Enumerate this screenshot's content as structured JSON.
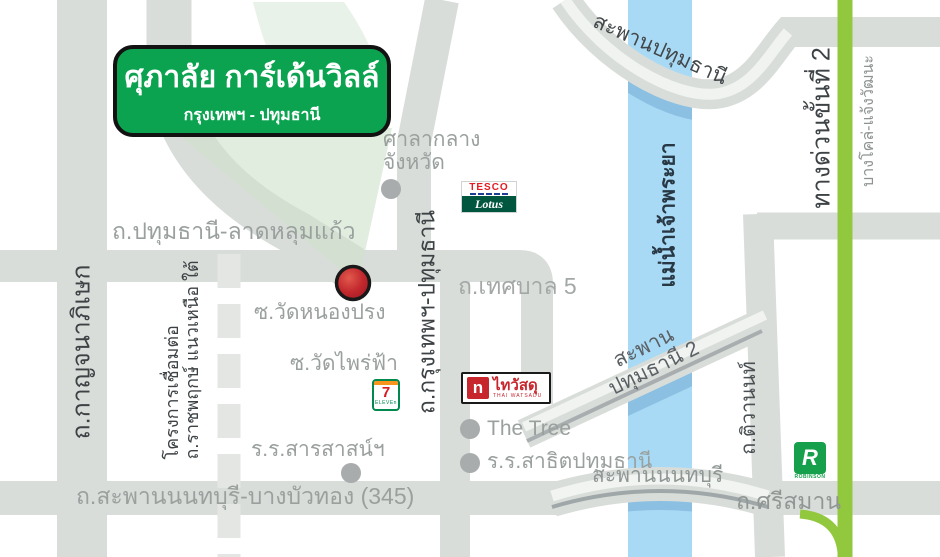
{
  "project_badge": {
    "title": "ศุภาลัย การ์เด้นวิลล์",
    "subtitle": "กรุงเทพฯ - ปทุมธานี"
  },
  "roads": {
    "kanchanaphisek": "ถ.กาญจนาภิเษก",
    "pathumthani_latlumkaeo": "ถ.ปทุมธานี-ลาดหลุมแก้ว",
    "krungthep_pathumthani": "ถ.กรุงเทพฯ-ปทุมธานี",
    "thetsaban5": "ถ.เทศบาล 5",
    "ratchaphruek_project_line1": "โครงการเชื่อมต่อ",
    "ratchaphruek_project_line2": "ถ.ราชพฤกษ์ แนวเหนือ ใต้",
    "soi_wat_nong_prong": "ซ.วัดหนองปรง",
    "soi_wat_phrai_fa": "ซ.วัดไพร่ฟ้า",
    "saphan_nonthaburi_bangbuathong": "ถ.สะพานนนทบุรี-บางบัวทอง (345)",
    "tiwanon": "ถ.ติวานนท์",
    "srisaman": "ถ.ศรีสมาน"
  },
  "expressway": {
    "name": "ทางด่วนขั้นที่ 2",
    "route": "บางโคล่-แจ้งวัฒนะ",
    "color": "#92c83e"
  },
  "river": {
    "name": "แม่น้ำเจ้าพระยา",
    "color": "#a9daf5"
  },
  "bridges": {
    "pathumthani": "สะพานปทุมธานี",
    "pathumthani2_line1": "สะพาน",
    "pathumthani2_line2": "ปทุมธานี 2",
    "nonthaburi": "สะพานนนทบุรี"
  },
  "landmarks": {
    "provincial_hall_line1": "ศาลากลาง",
    "provincial_hall_line2": "จังหวัด",
    "the_tree": "The Tree",
    "sarasas_school": "ร.ร.สารสาสน์ฯ",
    "satit_pathumthani_school": "ร.ร.สาธิตปทุมธานี"
  },
  "logos": {
    "tesco": "TESCO",
    "lotus": "Lotus",
    "seven": "7",
    "eleven": "ELEVEn",
    "thaiwatsadu_house": "n",
    "thaiwatsadu": "ไทวัสดุ",
    "thaiwatsadu_en": "THAI WATSADU",
    "robinson_r": "R",
    "robinson": "ROBINSON"
  },
  "colors": {
    "road_gray": "#d9ddd9",
    "badge_green": "#0ba350",
    "marker_red": "#c1272d",
    "river_blue": "#a9daf5",
    "expressway_green": "#92c83e"
  }
}
